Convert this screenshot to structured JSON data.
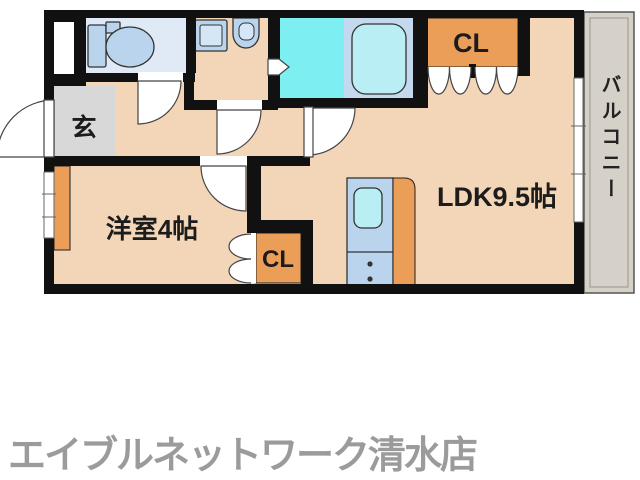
{
  "rooms": {
    "entrance": {
      "label": "玄"
    },
    "western_room": {
      "label": "洋室4帖"
    },
    "ldk": {
      "label": "LDK9.5帖"
    },
    "balcony": {
      "label": "バルコニー"
    }
  },
  "closets": {
    "top": {
      "label": "CL"
    },
    "bottom": {
      "label": "CL"
    }
  },
  "fixtures": [
    "toilet",
    "washing-machine",
    "sink",
    "bathtub",
    "kitchen-unit"
  ],
  "footer": {
    "store_name": "エイブルネットワーク清水店"
  },
  "colors": {
    "wall": "#111111",
    "floor": "#f3d5b8",
    "accent_orange": "#eb9e57",
    "toilet_floor": "#dfeaf6",
    "bath_floor": "#7deef2",
    "tub_area": "#c5d9ee",
    "fixture_blue": "#b9d4ec",
    "fixture_cyan": "#b8eef4",
    "genkan_gray": "#d8d8d8",
    "balcony_gray": "#d6d1c8",
    "store_text": "#9b9b9b"
  }
}
